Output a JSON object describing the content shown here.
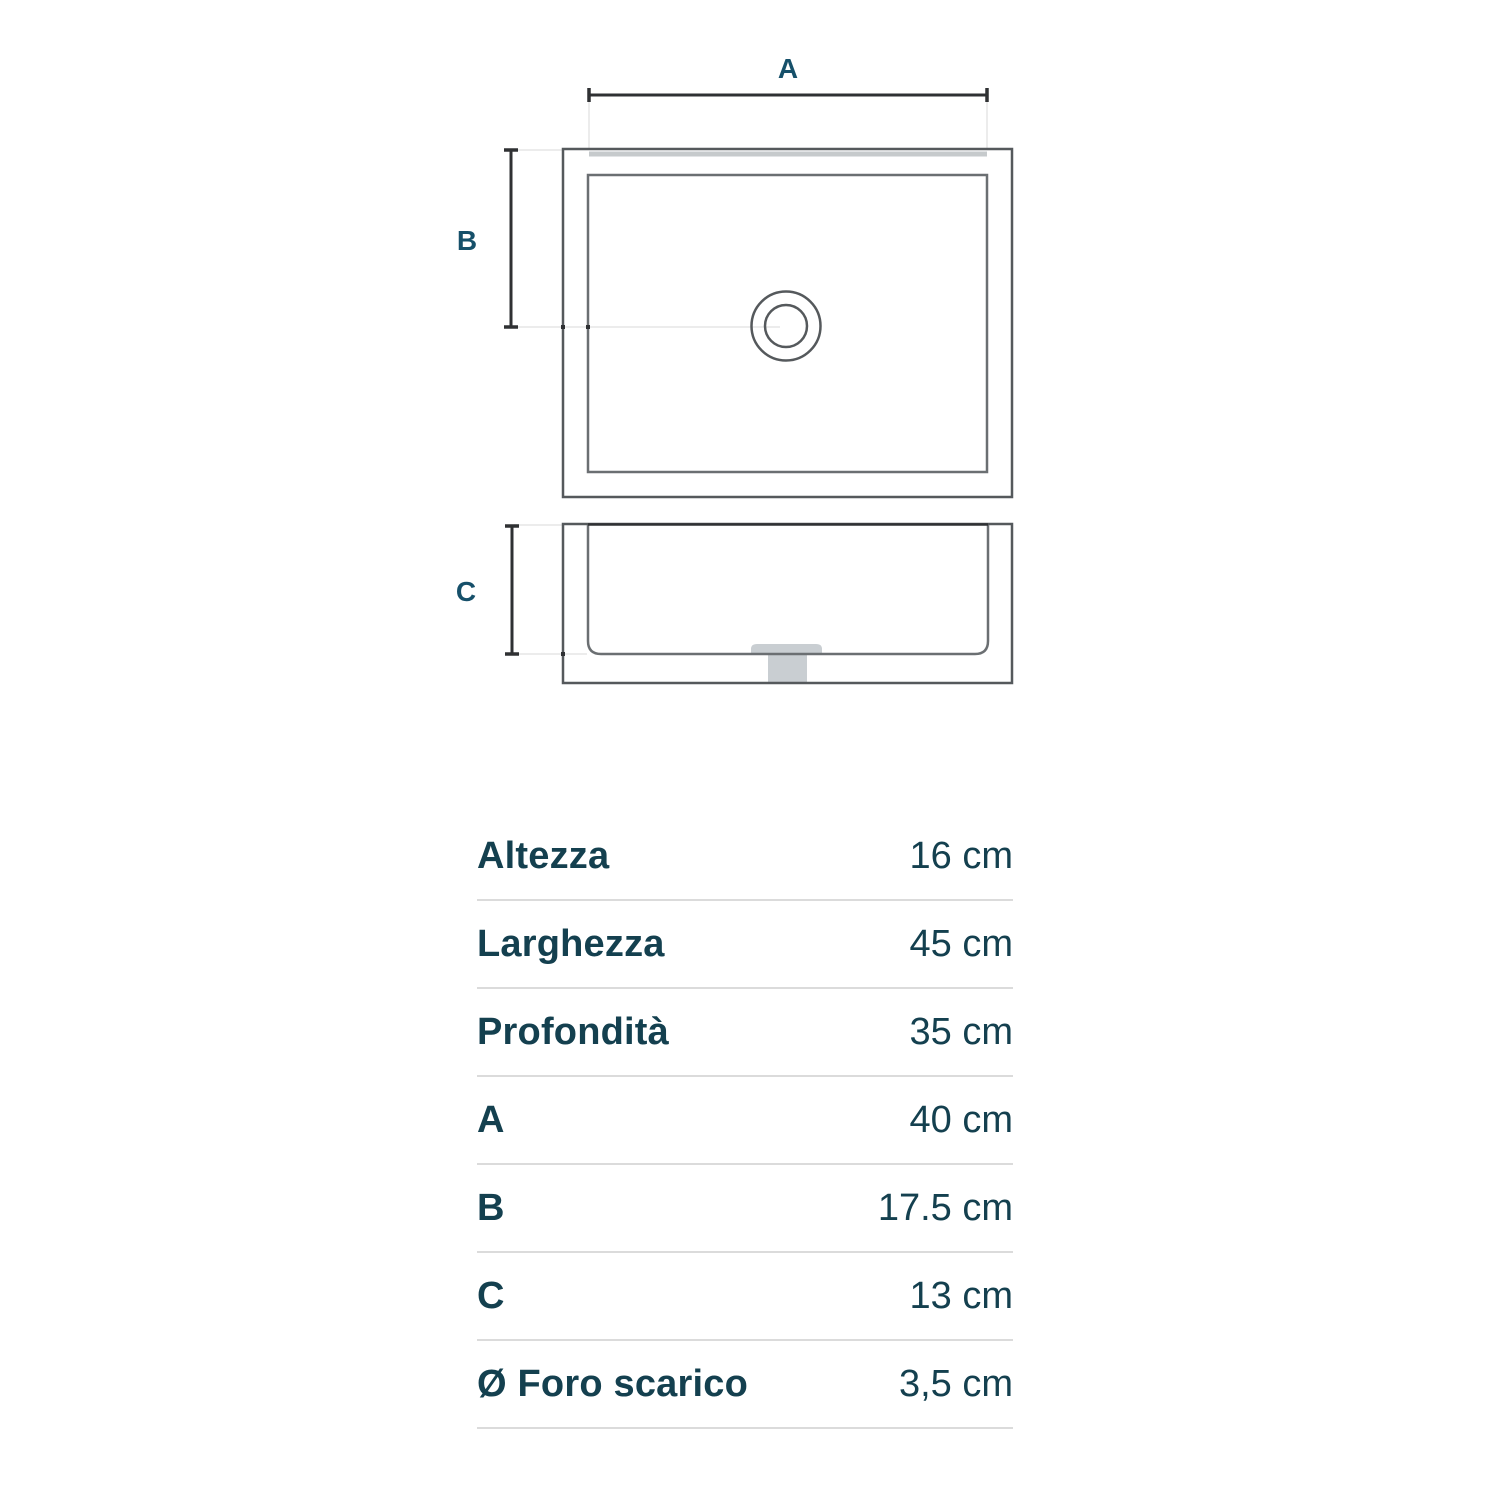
{
  "page": {
    "background_color": "#ffffff"
  },
  "diagram": {
    "type": "sink-technical-drawing",
    "views": [
      "top-view",
      "side-view"
    ],
    "dim_labels": {
      "a": "A",
      "b": "B",
      "c": "C"
    },
    "colors": {
      "dimension_line": "#2f3133",
      "outer_outline": "#55595c",
      "inner_outline": "#6b6f72",
      "rim_accent_gray": "#c6cacc",
      "drain_fill": "#c9ced2",
      "extension_line": "#ececec",
      "label_text": "#16506a"
    }
  },
  "table": {
    "text_color": "#14404f",
    "divider_color": "#dbdbdb",
    "rows": [
      {
        "label": "Altezza",
        "value": "16 cm"
      },
      {
        "label": "Larghezza",
        "value": "45 cm"
      },
      {
        "label": "Profondità",
        "value": "35 cm"
      },
      {
        "label": "A",
        "value": "40 cm"
      },
      {
        "label": "B",
        "value": "17.5 cm"
      },
      {
        "label": "C",
        "value": "13 cm"
      },
      {
        "label": "Ø Foro scarico",
        "value": "3,5 cm"
      }
    ]
  }
}
